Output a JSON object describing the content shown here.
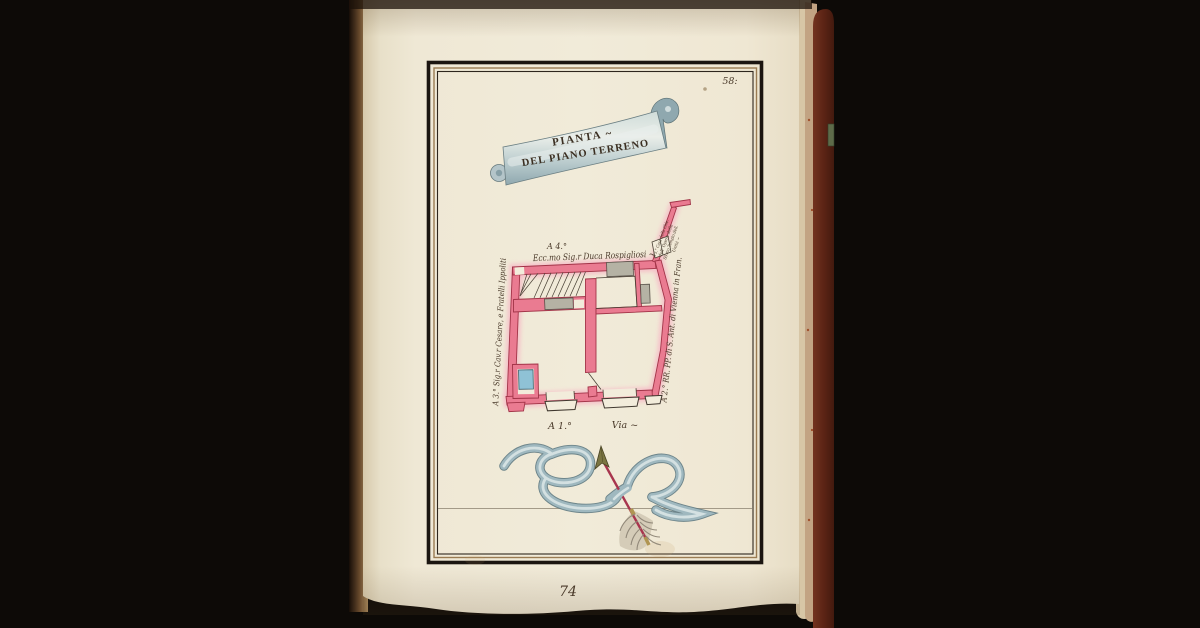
{
  "plate": {
    "number": "58:",
    "folio_pencil": "74"
  },
  "banner": {
    "line1": "PIANTA ~",
    "line2": "DEL PIANO TERRENO"
  },
  "plan": {
    "label_a4_ref": "A 4.°",
    "label_a4": "Ecc.mo Sig.r Duca Rospigliosi ~",
    "label_a3": "A 3.° Sig.r Cav.r Cesare, e Fratelli Ippoliti",
    "label_a2": "A 2.° RR. PP. di S. Ant. di Vienna in Fran.",
    "label_a5_lines": [
      "A 5.° Casa della Chie.",
      "dell' Opera della",
      "SS.mo Tempio dell.",
      "Unità ~"
    ],
    "label_a1": "A 1.°",
    "label_via": "Via ~"
  },
  "colors": {
    "background": "#0d0a07",
    "page": "#f0e9d7",
    "book_cover": "#5f2619",
    "plan_wall_pink": "#ea7b91",
    "plan_wall_halo": "#f6b9c6",
    "basin_blue": "#8fc2d6",
    "niche_grey": "#b5b2a4",
    "ribbon_blue": "#9db6bd",
    "arrow_red": "#a8354e",
    "ink": "#4a4236"
  }
}
